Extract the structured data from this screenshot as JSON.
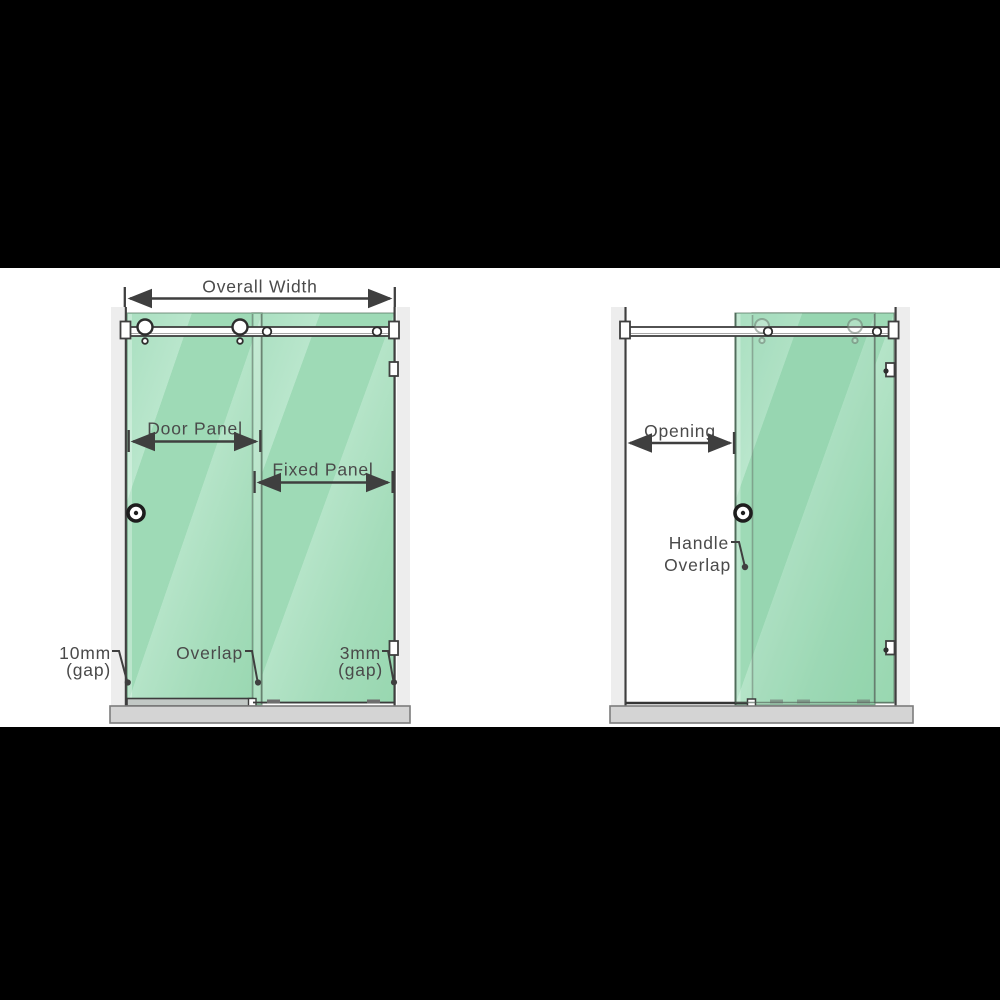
{
  "closed": {
    "overall_width": "Overall Width",
    "door_panel": "Door Panel",
    "fixed_panel": "Fixed Panel",
    "left_gap_value": "10mm",
    "left_gap_suffix": "(gap)",
    "overlap": "Overlap",
    "right_gap_value": "3mm",
    "right_gap_suffix": "(gap)"
  },
  "open": {
    "opening": "Opening",
    "handle": "Handle",
    "overlap": "Overlap"
  },
  "colors": {
    "glass_green": "#a3dcba",
    "glass_highlight": "#bde7cf",
    "frame_line": "#3f3f3f",
    "label_text": "#4a4a4a",
    "wall_strip": "#ededed",
    "base_tray": "#d4d4d4",
    "background_bar": "#000000",
    "canvas_background": "#ffffff"
  }
}
